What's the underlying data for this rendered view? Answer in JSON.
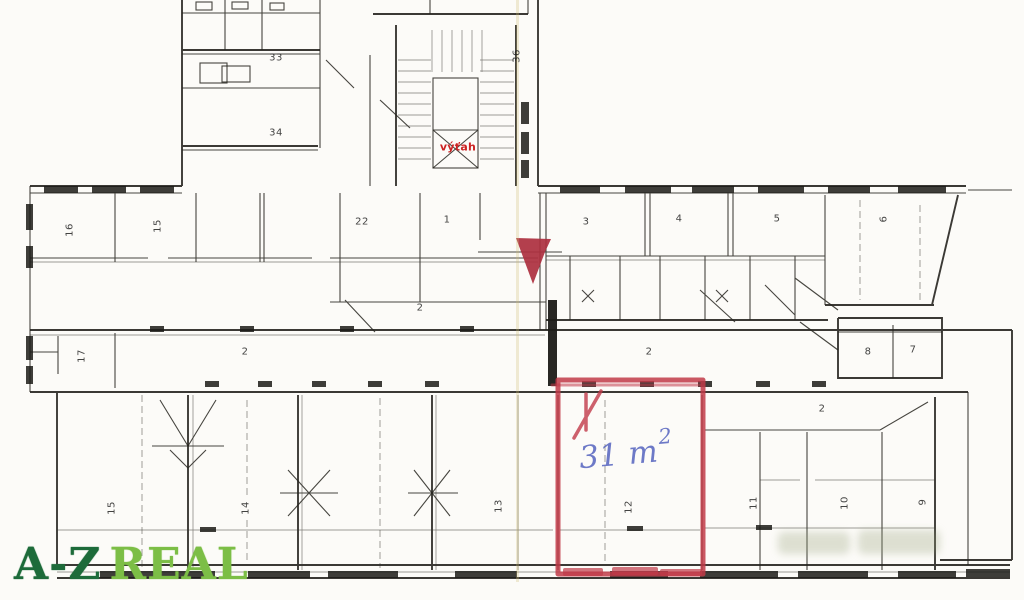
{
  "logo": {
    "prefix": "A-Z",
    "suffix": "REAL"
  },
  "elevator": {
    "label": "výťah"
  },
  "highlight": {
    "area_text": "31 m",
    "area_sup": "2"
  },
  "colors": {
    "marker_red": "#c13a48",
    "flag_red": "#ad2f3e",
    "hand_blue": "#5e6cc2",
    "logo_dark": "#1d6b3a",
    "logo_light": "#7cbe46",
    "ink": "#26241f"
  },
  "rooms": {
    "r33": "33",
    "r34": "34",
    "r36": "36",
    "r16": "16",
    "r15": "15",
    "r22": "22",
    "r1": "1",
    "r3": "3",
    "r4": "4",
    "r5": "5",
    "r6": "6",
    "r17": "17",
    "c1": "2",
    "c2": "2",
    "c3": "2",
    "c4": "2",
    "r8": "8",
    "r7": "7",
    "b15": "15",
    "b14": "14",
    "b13": "13",
    "b12": "12",
    "b11": "11",
    "b10": "10",
    "b9": "9"
  }
}
